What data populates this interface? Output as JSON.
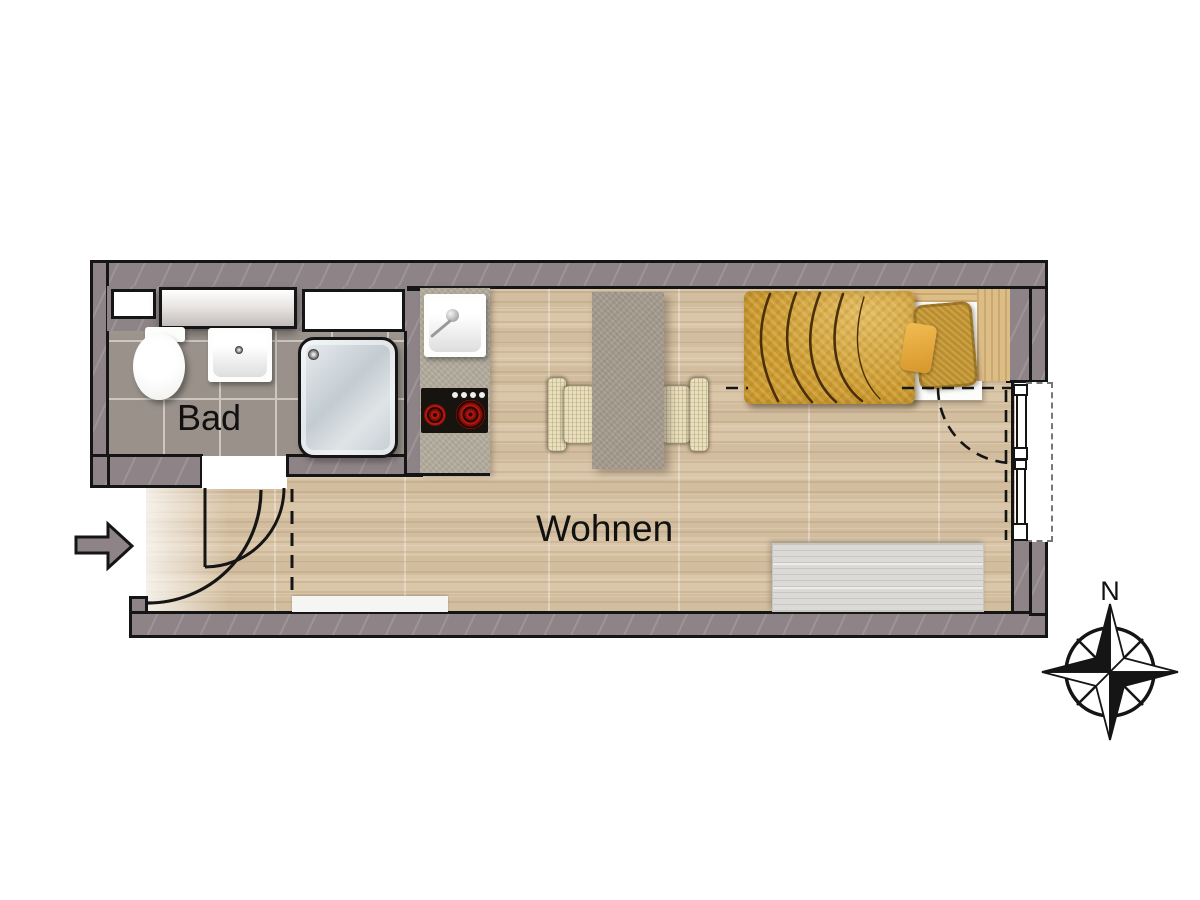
{
  "labels": {
    "bathroom": "Bad",
    "living": "Wohnen",
    "compass_north": "N"
  },
  "theme": {
    "wall": "#8e8487",
    "outline": "#151515",
    "wood": "#d8c5a8",
    "tile": "#99918a",
    "grout": "#cdc7c0",
    "counter": "#b2ab9d",
    "stove": "#17130f",
    "burner": "#b3170c",
    "table": "#a49b8e",
    "chair": "#e8dfbd",
    "duvet": "#c9992f",
    "duvet_line": "#4a3008",
    "pillow": "#bb8f2f",
    "pillow_small": "#d6962b",
    "headboard": "#ddbd86",
    "sideboard": "#dbdad7",
    "shower_light": "#e9edef",
    "shower_dark": "#c3ccd2",
    "floor_white": "#f5f5f3"
  }
}
